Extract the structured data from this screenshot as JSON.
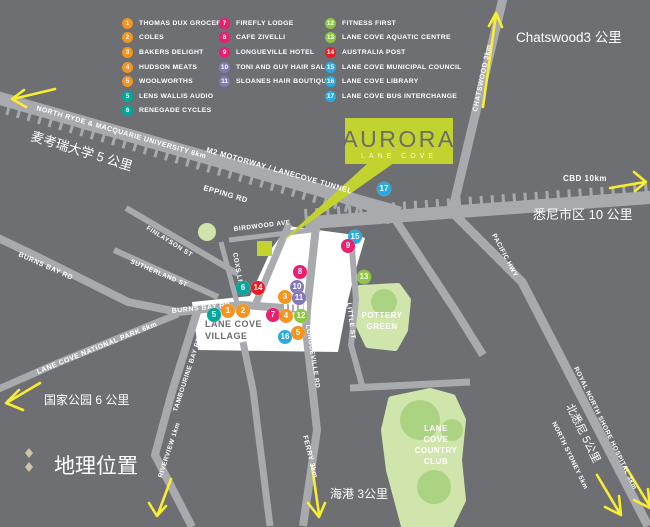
{
  "colors": {
    "background": "#6d6f72",
    "road": "#a8aaad",
    "village": "#ffffff",
    "park_light": "#cfe5ab",
    "park_dark": "#abd381",
    "lime": "#c2d22f",
    "arrow_yellow": "#f9ed32",
    "markers": {
      "orange": "#f7941e",
      "teal": "#00a79c",
      "pink": "#ec1e70",
      "purple": "#8179b9",
      "green": "#8dc63f",
      "red": "#ed1c24",
      "blue": "#29abe2"
    }
  },
  "logo": {
    "title": "AURORA",
    "subtitle": "LANE COVE"
  },
  "legend": {
    "items": [
      {
        "num": "1",
        "color": "orange",
        "label": "THOMAS DUX GROCER",
        "col": 1
      },
      {
        "num": "2",
        "color": "orange",
        "label": "COLES",
        "col": 1
      },
      {
        "num": "3",
        "color": "orange",
        "label": "BAKERS DELIGHT",
        "col": 1
      },
      {
        "num": "4",
        "color": "orange",
        "label": "HUDSON MEATS",
        "col": 1
      },
      {
        "num": "5",
        "color": "orange",
        "label": "WOOLWORTHS",
        "col": 1
      },
      {
        "num": "5",
        "color": "teal",
        "label": "LENS WALLIS AUDIO",
        "col": 1
      },
      {
        "num": "6",
        "color": "teal",
        "label": "RENEGADE CYCLES",
        "col": 1
      },
      {
        "num": "7",
        "color": "pink",
        "label": "FIREFLY LODGE",
        "col": 2
      },
      {
        "num": "8",
        "color": "pink",
        "label": "CAFE ZIVELLI",
        "col": 2
      },
      {
        "num": "9",
        "color": "pink",
        "label": "LONGUEVILLE HOTEL",
        "col": 2
      },
      {
        "num": "10",
        "color": "purple",
        "label": "TONI AND GUY HAIR SALON",
        "col": 2
      },
      {
        "num": "11",
        "color": "purple",
        "label": "SLOANES HAIR BOUTIQUE",
        "col": 2
      },
      {
        "num": "12",
        "color": "green",
        "label": "FITNESS FIRST",
        "col": 3
      },
      {
        "num": "13",
        "color": "green",
        "label": "LANE COVE AQUATIC CENTRE",
        "col": 3
      },
      {
        "num": "14",
        "color": "red",
        "label": "AUSTRALIA POST",
        "col": 3
      },
      {
        "num": "15",
        "color": "blue",
        "label": "LANE COVE MUNICIPAL COUNCIL",
        "col": 3
      },
      {
        "num": "16",
        "color": "blue",
        "label": "LANE COVE LIBRARY",
        "col": 3
      },
      {
        "num": "17",
        "color": "blue",
        "label": "LANE COVE BUS INTERCHANGE",
        "col": 3
      }
    ]
  },
  "map": {
    "labels": {
      "m2": "M2 MOTORWAY / LANECOVE TUNNEL",
      "epping": "EPPING RD",
      "birdwood": "BIRDWOOD AVE",
      "finlayson": "FINLAYSON ST",
      "sutherland": "SUTHERLAND ST",
      "coxs": "COXS LN",
      "burns_bay": "BURNS BAY RD",
      "burns_bay_2": "BURNS BAY RD",
      "rosenthal": "ROSENTHAL AVE",
      "longueville": "LONGUEVILLE RD",
      "little": "LITTLE ST",
      "tambourine": "TAMBOURINE BAY RD",
      "pacific": "PACIFIC HWY",
      "north_ryde": "NORTH RYDE & MACQUARIE UNIVERSITY 6km",
      "chatswood": "CHATSWOOD 3km",
      "cbd": "CBD 10km",
      "national_park": "LANE COVE NATIONAL PARK 6km",
      "riverview": "RIVERVIEW 1km",
      "ferry": "FERRY 3km",
      "hospital": "ROYAL NORTH SHORE HOSPITAL 3km",
      "north_sydney": "NORTH SYDNEY 5km"
    },
    "chinese": {
      "macquarie": "麦考瑞大学 5 公里",
      "chatswood": "Chatswood3 公里",
      "sydney_cbd": "悉尼市区 10 公里",
      "national_park": "国家公园 6 公里",
      "harbour": "海港 3公里",
      "north_sydney": "北悉尼 5公里",
      "geo_title": "地理位置"
    },
    "areas": {
      "village_1": "LANE COVE",
      "village_2": "VILLAGE",
      "pottery_1": "POTTERY",
      "pottery_2": "GREEN",
      "club_1": "LANE",
      "club_2": "COVE",
      "club_3": "COUNTRY",
      "club_4": "CLUB"
    },
    "markers": [
      {
        "num": "17",
        "color": "blue",
        "x": 384,
        "y": 189
      },
      {
        "num": "15",
        "color": "blue",
        "x": 355,
        "y": 237
      },
      {
        "num": "9",
        "color": "pink",
        "x": 348,
        "y": 246
      },
      {
        "num": "13",
        "color": "green",
        "x": 364,
        "y": 277
      },
      {
        "num": "8",
        "color": "pink",
        "x": 300,
        "y": 272
      },
      {
        "num": "10",
        "color": "purple",
        "x": 297,
        "y": 287
      },
      {
        "num": "3",
        "color": "orange",
        "x": 285,
        "y": 297
      },
      {
        "num": "11",
        "color": "purple",
        "x": 299,
        "y": 298
      },
      {
        "num": "6",
        "color": "teal",
        "x": 243,
        "y": 288
      },
      {
        "num": "14",
        "color": "red",
        "x": 258,
        "y": 288
      },
      {
        "num": "1",
        "color": "orange",
        "x": 228,
        "y": 311
      },
      {
        "num": "2",
        "color": "orange",
        "x": 243,
        "y": 311
      },
      {
        "num": "5",
        "color": "teal",
        "x": 214,
        "y": 315
      },
      {
        "num": "7",
        "color": "pink",
        "x": 273,
        "y": 315
      },
      {
        "num": "4",
        "color": "orange",
        "x": 286,
        "y": 316
      },
      {
        "num": "12",
        "color": "green",
        "x": 301,
        "y": 316
      },
      {
        "num": "16",
        "color": "blue",
        "x": 285,
        "y": 337
      },
      {
        "num": "5",
        "color": "orange",
        "x": 298,
        "y": 333
      }
    ]
  }
}
